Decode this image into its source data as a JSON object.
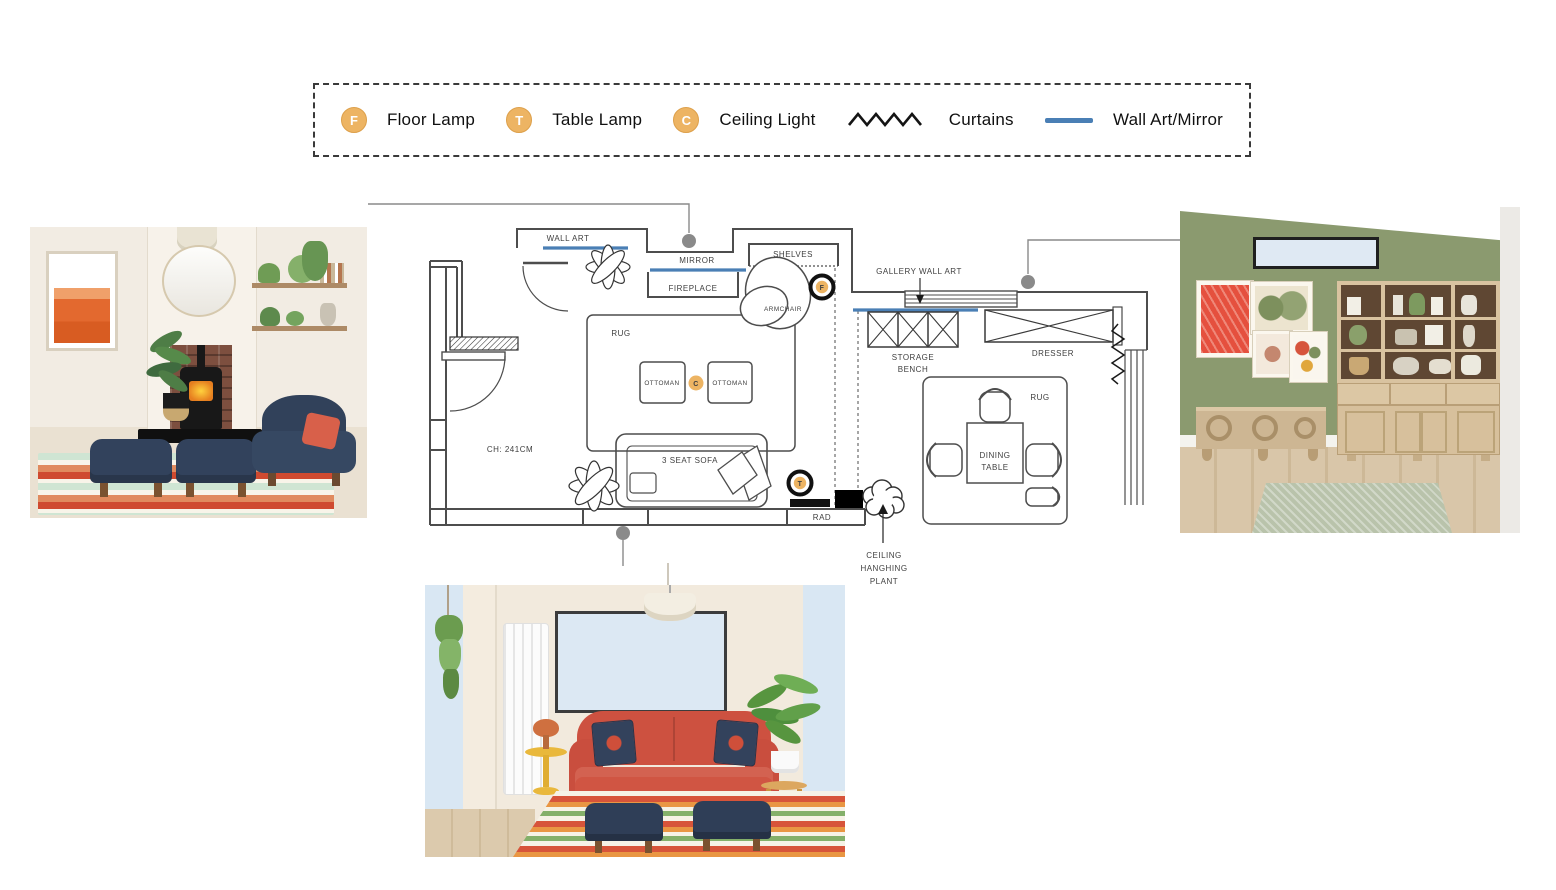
{
  "legend": {
    "items": [
      {
        "symbol": "F",
        "label": "Floor Lamp"
      },
      {
        "symbol": "T",
        "label": "Table Lamp"
      },
      {
        "symbol": "C",
        "label": "Ceiling Light"
      },
      {
        "symbol": "curtains-zigzag",
        "label": "Curtains"
      },
      {
        "symbol": "blue-line",
        "label": "Wall Art/Mirror"
      }
    ]
  },
  "floor_plan": {
    "labels": {
      "wall_art": "WALL ART",
      "mirror": "MIRROR",
      "fireplace": "FIREPLACE",
      "shelves": "SHELVES",
      "gallery_wall_art": "GALLERY WALL ART",
      "storage_bench_1": "STORAGE",
      "storage_bench_2": "BENCH",
      "dresser": "DRESSER",
      "living_rug": "RUG",
      "ottoman_left": "OTTOMAN",
      "ottoman_right": "OTTOMAN",
      "armchair": "ARMCHAIR",
      "sofa": "3 SEAT SOFA",
      "ceiling_height": "CH: 241CM",
      "radiator": "RAD",
      "dining_rug": "RUG",
      "dining_table_1": "DINING",
      "dining_table_2": "TABLE",
      "ceiling_plant_1": "CEILING",
      "ceiling_plant_2": "HANGHING",
      "ceiling_plant_3": "PLANT",
      "floor_lamp_symbol": "F",
      "table_lamp_symbol": "T",
      "ceiling_light_symbol": "C"
    }
  },
  "colors": {
    "accent_blue_wall_art": "#4a7fb5",
    "lamp_symbol_orange": "#edb463",
    "plan_line": "#4d4d4d",
    "callout_gray": "#8a8a8a",
    "sage_wall": "#8b9a6f",
    "navy_furniture": "#33425c",
    "coral_sofa": "#cd5140",
    "cream_wall": "#f2ece3"
  }
}
